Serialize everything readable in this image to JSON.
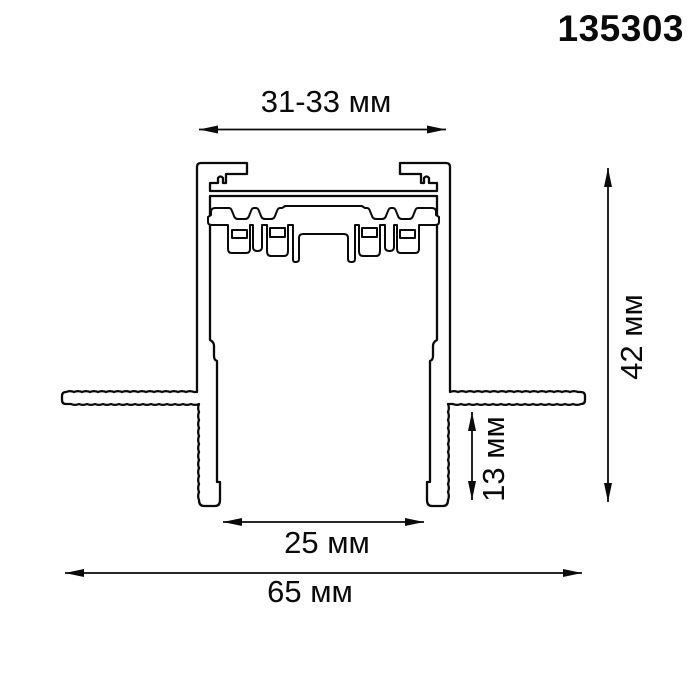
{
  "part_number": "135303",
  "dims": {
    "top_width": "31-33 мм",
    "height": "42 мм",
    "recess_depth": "13 мм",
    "opening_width": "25 мм",
    "overall_width": "65 мм"
  },
  "colors": {
    "line": "#0a0a0a",
    "background": "#ffffff"
  }
}
